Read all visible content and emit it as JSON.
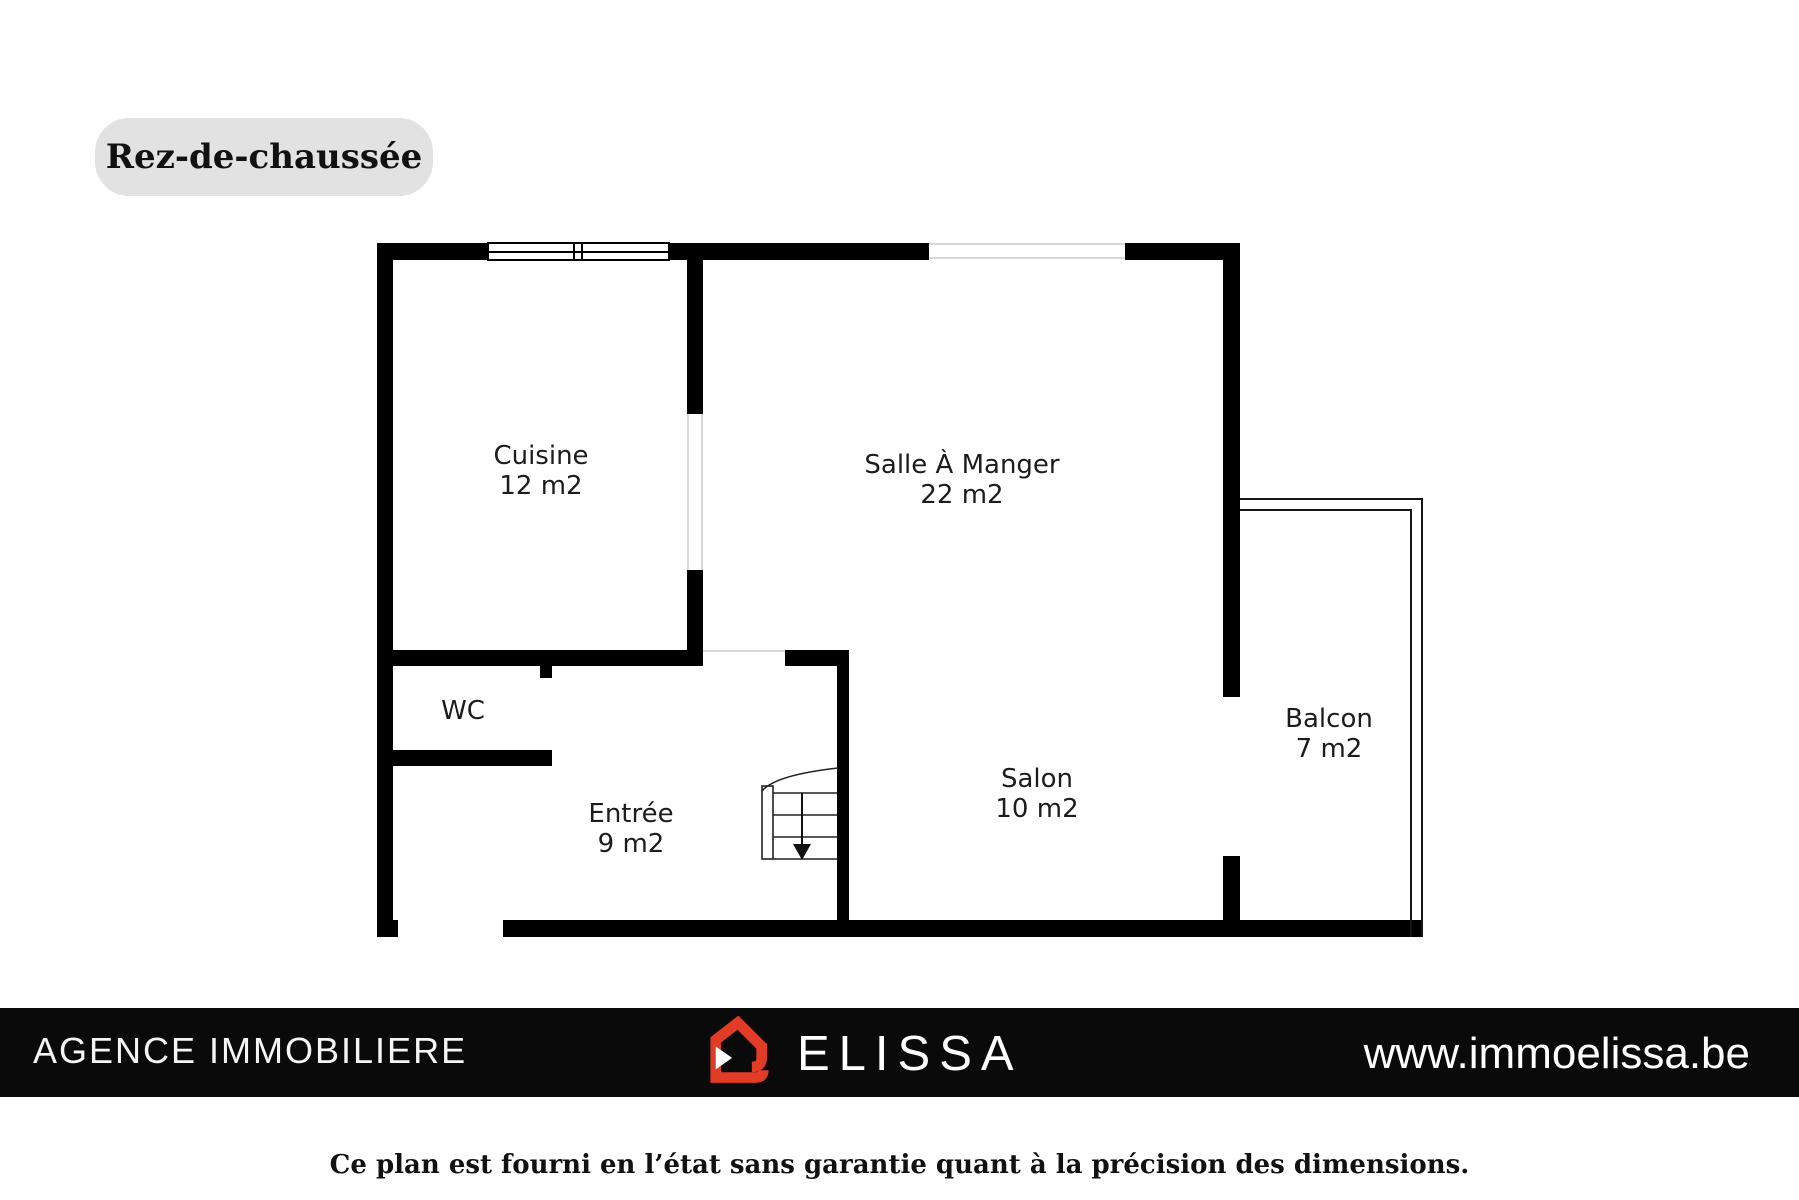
{
  "page": {
    "title_badge": "Rez-de-chaussée",
    "disclaimer": "Ce plan est fourni en l’état sans garantie quant à la précision des dimensions."
  },
  "floorplan": {
    "rooms": [
      {
        "name": "Cuisine",
        "area": "12 m2"
      },
      {
        "name": "Salle À Manger",
        "area": "22 m2"
      },
      {
        "name": "WC",
        "area": ""
      },
      {
        "name": "Entrée",
        "area": "9 m2"
      },
      {
        "name": "Salon",
        "area": "10 m2"
      },
      {
        "name": "Balcon",
        "area": "7 m2"
      }
    ],
    "features": [
      "window",
      "stairs-down-arrow",
      "balcony-outline"
    ]
  },
  "footer": {
    "agency": "AGENCE IMMOBILIERE",
    "brand": "ELISSA",
    "website": "www.immoelissa.be",
    "logo_icon": "house-icon"
  },
  "colors": {
    "wall": "#000000",
    "badge_bg": "#e2e2e2",
    "logo_red": "#e23b26",
    "footer_bg": "#0a0a0a"
  }
}
